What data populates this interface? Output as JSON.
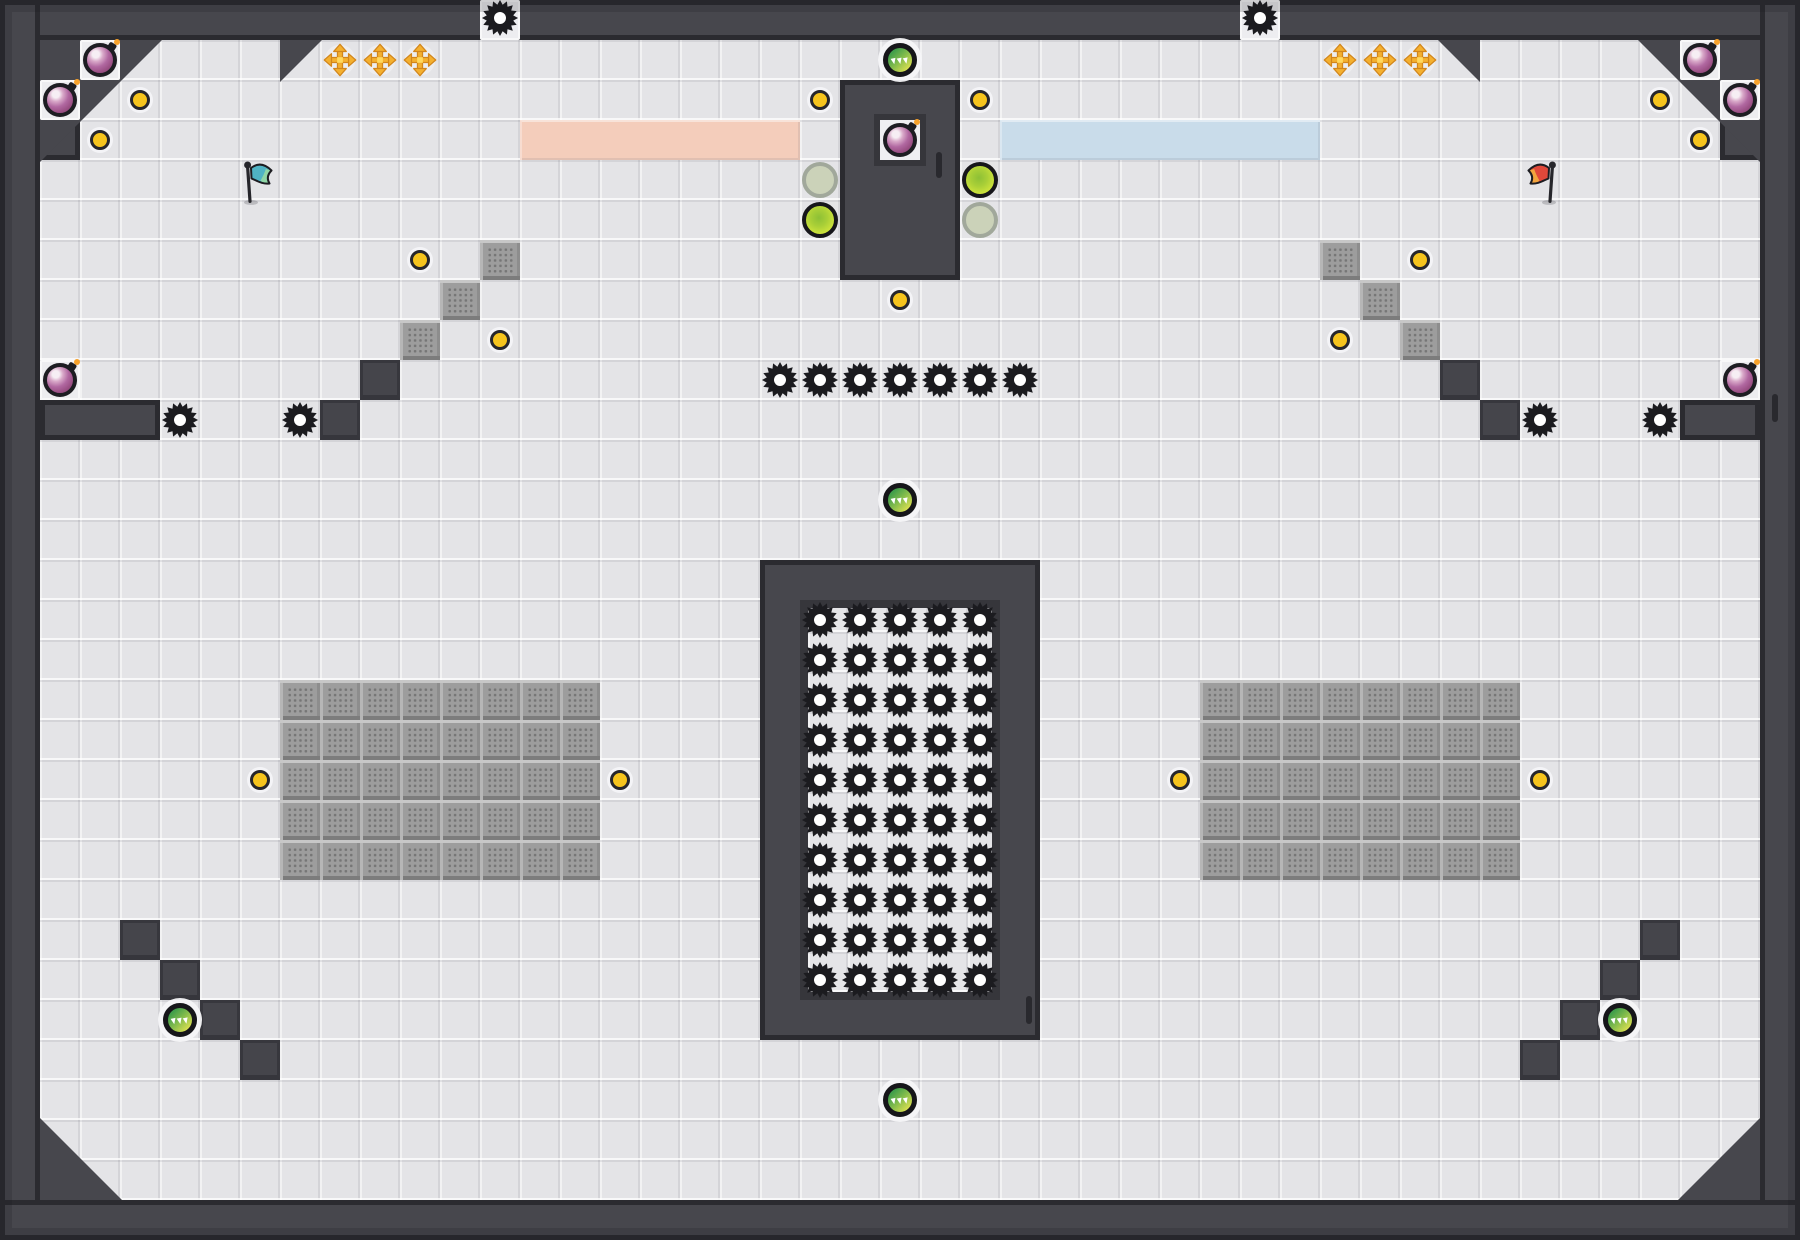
{
  "scene": {
    "name": "arena-map",
    "width": 1800,
    "height": 1240,
    "tile": 40
  },
  "colors": {
    "wall": "#47474d",
    "wall_edge": "#2b2b30",
    "wall_dark": "#3a3a40",
    "tile": "#e4e4e7",
    "pocket": "#ededf0",
    "gold": "#f6c41d",
    "gear": "#1b1b1f",
    "bomb": "#a4548f",
    "pad_green": "#c4dd3a",
    "pad_inactive": "#c9d1b5",
    "portal_green": "#4aa04e",
    "portal_yellow": "#dde050",
    "strip_pink": "#f4cdbb",
    "strip_blue": "#c9dcea",
    "flag_teal": "#4fb3c4",
    "flag_teal_tip": "#8fd6a6",
    "flag_red": "#e0483a",
    "flag_red_tip": "#f2a43e",
    "cross_gold": "#f4b02f",
    "cross_edge": "#d2861c"
  },
  "walls": [
    {
      "x": 0,
      "y": 0,
      "w": 1800,
      "h": 40,
      "name": "top-wall"
    },
    {
      "x": 0,
      "y": 0,
      "w": 40,
      "h": 1240,
      "name": "left-wall"
    },
    {
      "x": 1760,
      "y": 0,
      "w": 40,
      "h": 1240,
      "name": "right-wall"
    },
    {
      "x": 0,
      "y": 1200,
      "w": 1800,
      "h": 40,
      "name": "bottom-wall"
    },
    {
      "x": 40,
      "y": 400,
      "w": 120,
      "h": 40,
      "name": "left-ledge"
    },
    {
      "x": 1680,
      "y": 400,
      "w": 80,
      "h": 40,
      "name": "right-ledge"
    },
    {
      "x": 840,
      "y": 80,
      "w": 120,
      "h": 200,
      "name": "top-center-box"
    },
    {
      "x": 40,
      "y": 120,
      "w": 40,
      "h": 40,
      "name": "corner-filler-left"
    },
    {
      "x": 1720,
      "y": 120,
      "w": 40,
      "h": 40,
      "name": "corner-filler-right"
    }
  ],
  "central_structure": {
    "outer": {
      "x": 760,
      "y": 560,
      "w": 280,
      "h": 480
    },
    "inner": {
      "x": 800,
      "y": 600,
      "w": 200,
      "h": 400
    }
  },
  "wedges": [
    {
      "pts": [
        [
          40,
          40
        ],
        [
          162,
          40
        ],
        [
          40,
          162
        ]
      ],
      "name": "corner-wedge-top-left"
    },
    {
      "pts": [
        [
          1760,
          40
        ],
        [
          1638,
          40
        ],
        [
          1760,
          162
        ]
      ],
      "name": "corner-wedge-top-right"
    },
    {
      "pts": [
        [
          40,
          1200
        ],
        [
          40,
          1118
        ],
        [
          122,
          1200
        ]
      ],
      "name": "corner-wedge-bottom-left"
    },
    {
      "pts": [
        [
          1760,
          1200
        ],
        [
          1760,
          1118
        ],
        [
          1678,
          1200
        ]
      ],
      "name": "corner-wedge-bottom-right"
    },
    {
      "pts": [
        [
          280,
          40
        ],
        [
          322,
          40
        ],
        [
          280,
          82
        ]
      ],
      "name": "wall-tooth-left"
    },
    {
      "pts": [
        [
          1438,
          40
        ],
        [
          1480,
          40
        ],
        [
          1480,
          82
        ]
      ],
      "name": "wall-tooth-right"
    }
  ],
  "notch_tiles": [
    [
      480,
      0
    ],
    [
      1240,
      0
    ]
  ],
  "pocket_tiles": [
    [
      80,
      40
    ],
    [
      40,
      80
    ],
    [
      1680,
      40
    ],
    [
      1720,
      80
    ],
    [
      40,
      360
    ],
    [
      1720,
      360
    ]
  ],
  "box_pocket": [
    880,
    120
  ],
  "strips": [
    {
      "x": 520,
      "y": 120,
      "w": 280,
      "h": 40,
      "color": "strip_pink",
      "name": "team-strip-pink"
    },
    {
      "x": 1000,
      "y": 120,
      "w": 320,
      "h": 40,
      "color": "strip_blue",
      "name": "team-strip-blue"
    }
  ],
  "blocks": [
    [
      360,
      360
    ],
    [
      320,
      400
    ],
    [
      1440,
      360
    ],
    [
      1480,
      400
    ],
    [
      120,
      920
    ],
    [
      160,
      960
    ],
    [
      200,
      1000
    ],
    [
      240,
      1040
    ],
    [
      1640,
      920
    ],
    [
      1600,
      960
    ],
    [
      1560,
      1000
    ],
    [
      1520,
      1040
    ]
  ],
  "crates": [
    [
      480,
      240
    ],
    [
      440,
      280
    ],
    [
      400,
      320
    ],
    [
      1320,
      240
    ],
    [
      1360,
      280
    ],
    [
      1400,
      320
    ]
  ],
  "crate_grids": [
    {
      "x": 280,
      "y": 680,
      "cols": 8,
      "rows": 5
    },
    {
      "x": 1200,
      "y": 680,
      "cols": 8,
      "rows": 5
    }
  ],
  "gears": [
    [
      500,
      18
    ],
    [
      1260,
      18
    ],
    [
      180,
      420
    ],
    [
      300,
      420
    ],
    [
      1540,
      420
    ],
    [
      1660,
      420
    ]
  ],
  "gear_row": {
    "x0": 780,
    "y": 380,
    "count": 7,
    "step": 40
  },
  "gear_grid": {
    "x0": 820,
    "y0": 620,
    "cols": 5,
    "rows": 10,
    "step": 40
  },
  "gold_dots": [
    [
      140,
      100
    ],
    [
      100,
      140
    ],
    [
      420,
      260
    ],
    [
      500,
      340
    ],
    [
      260,
      780
    ],
    [
      620,
      780
    ],
    [
      820,
      100
    ],
    [
      980,
      100
    ],
    [
      900,
      300
    ],
    [
      1660,
      100
    ],
    [
      1700,
      140
    ],
    [
      1420,
      260
    ],
    [
      1340,
      340
    ],
    [
      1180,
      780
    ],
    [
      1540,
      780
    ]
  ],
  "crosses": [
    [
      340,
      60
    ],
    [
      380,
      60
    ],
    [
      420,
      60
    ],
    [
      1340,
      60
    ],
    [
      1380,
      60
    ],
    [
      1420,
      60
    ]
  ],
  "bombs": [
    [
      100,
      60
    ],
    [
      60,
      100
    ],
    [
      1700,
      60
    ],
    [
      1740,
      100
    ],
    [
      60,
      380
    ],
    [
      1740,
      380
    ],
    [
      900,
      140
    ]
  ],
  "portals": [
    [
      900,
      60
    ],
    [
      900,
      500
    ],
    [
      180,
      1020
    ],
    [
      1620,
      1020
    ],
    [
      900,
      1100
    ]
  ],
  "pads": [
    {
      "x": 820,
      "y": 220,
      "state": "active"
    },
    {
      "x": 980,
      "y": 180,
      "state": "active"
    },
    {
      "x": 820,
      "y": 180,
      "state": "inactive"
    },
    {
      "x": 980,
      "y": 220,
      "state": "inactive"
    }
  ],
  "flags": [
    {
      "x": 260,
      "y": 180,
      "variant": "teal"
    },
    {
      "x": 1540,
      "y": 180,
      "variant": "red"
    }
  ],
  "slits": [
    [
      936,
      152,
      6,
      26
    ],
    [
      1026,
      996,
      6,
      28
    ],
    [
      1772,
      394,
      6,
      28
    ]
  ]
}
